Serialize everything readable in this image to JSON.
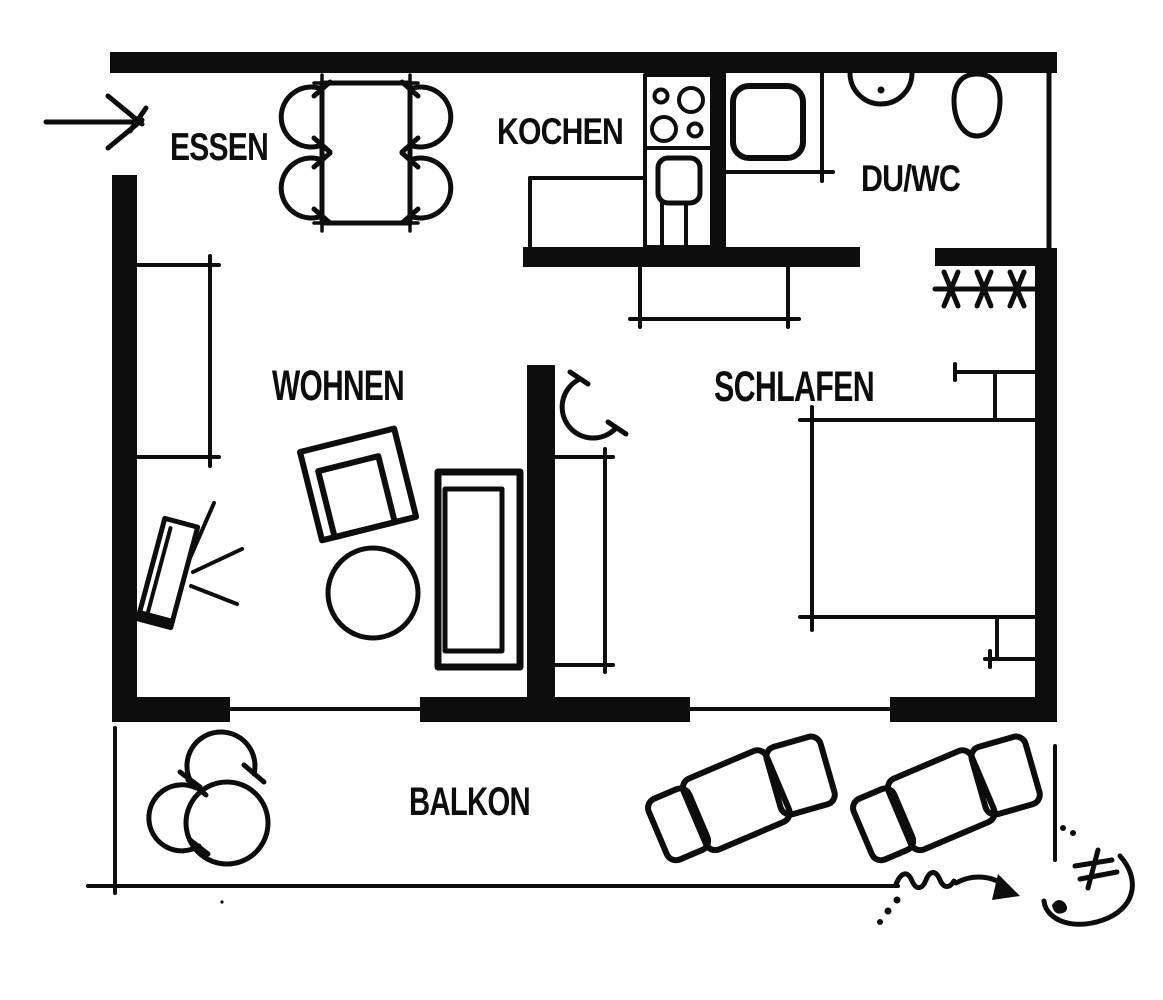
{
  "title": "Apartment floor plan",
  "colors": {
    "ink": "#0d0d0d",
    "paper": "#ffffff"
  },
  "rooms": {
    "essen": {
      "label": "ESSEN"
    },
    "kochen": {
      "label": "KOCHEN"
    },
    "duwc": {
      "label": "DU/WC"
    },
    "wohnen": {
      "label": "WOHNEN"
    },
    "schlafen": {
      "label": "SCHLAFEN"
    },
    "balkon": {
      "label": "BALKON"
    }
  },
  "symbols": {
    "entrance": "entrance-arrow",
    "wardrobe_rail": "clothes-rail-hatch",
    "door_swing": "door-swing-arc"
  }
}
